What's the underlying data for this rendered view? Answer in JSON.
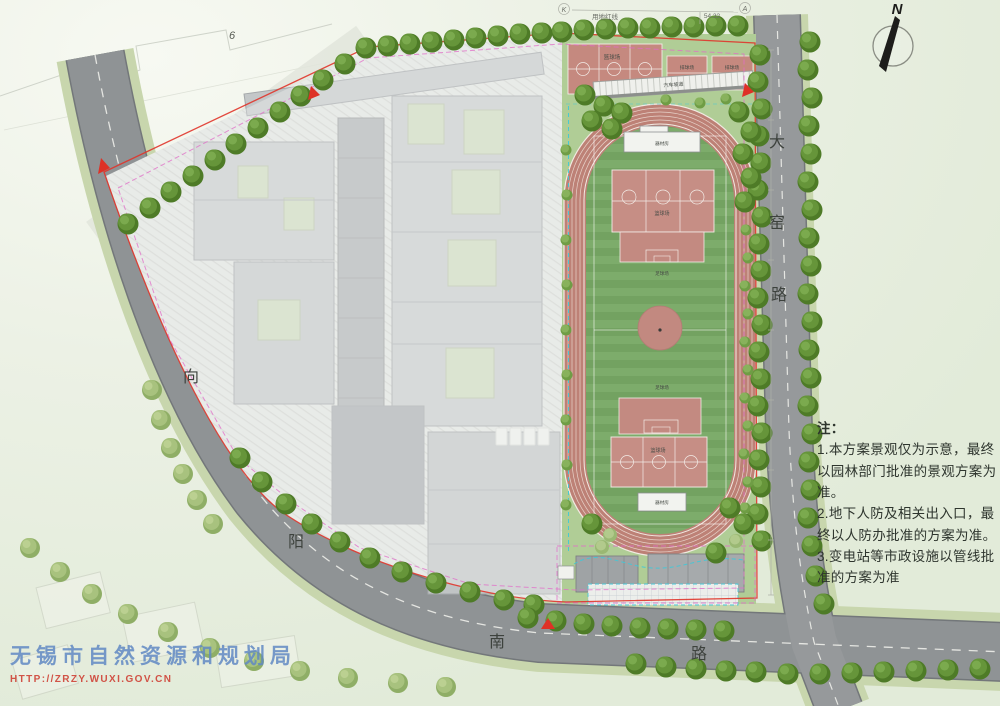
{
  "map": {
    "compass_label": "N",
    "roads": {
      "dayao": {
        "chars": [
          "大",
          "窑",
          "路"
        ]
      },
      "xiangyang": {
        "chars": [
          "向",
          "阳",
          "南",
          "路"
        ]
      }
    },
    "survey": {
      "redline_label": "用地红线",
      "dimension": "54.32",
      "point_k": "K",
      "point_a": "A",
      "existing_building_floors": "6"
    },
    "facilities": {
      "basketball": "篮球场",
      "volleyball": "排球场",
      "car_ramp": "汽车坡道",
      "football": "足球场",
      "equipment_room": "器材房"
    }
  },
  "notes": {
    "heading": "注：",
    "items": [
      "1.本方案景观仅为示意，最终以园林部门批准的景观方案为准。",
      "2.地下人防及相关出入口，最终以人防办批准的方案为准。",
      "3.变电站等市政设施以管线批准的方案为准"
    ]
  },
  "watermark": {
    "agency": "无锡市自然资源和规划局",
    "url": "HTTP://ZRZY.WUXI.GOV.CN"
  },
  "colors": {
    "boundary_red": "#e0352b",
    "setback_magenta": "#e26cc8",
    "utility_cyan": "#3fc9d9",
    "track": "#bd8176",
    "field_green": "#78a667",
    "court_pink": "#c68e85",
    "watermark_blue": "#6189c4",
    "watermark_red": "#cf4236"
  }
}
